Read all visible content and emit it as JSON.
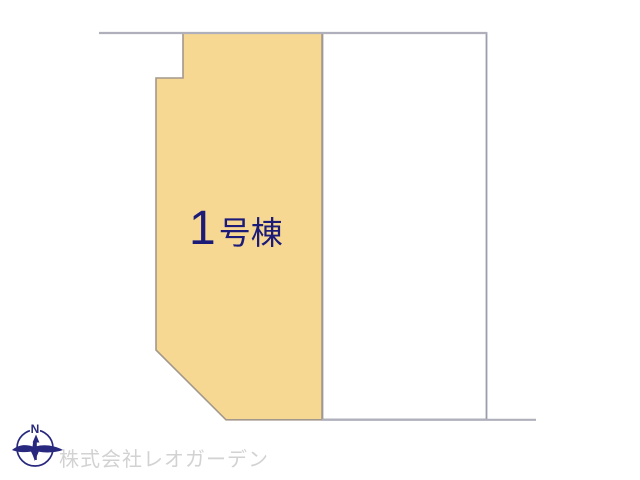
{
  "map": {
    "building_label": {
      "number": "1",
      "suffix": "号棟"
    },
    "compass": {
      "north_label": "N"
    },
    "footer": {
      "company_name": "株式会社レオガーデン"
    },
    "colors": {
      "plot_fill": "#f7d893",
      "plot_border": "#a3988c",
      "boundary_line": "#b0b0bc",
      "label_text": "#1c1c78",
      "company_text": "#d2d2d2",
      "compass_navy": "#28287e"
    }
  }
}
